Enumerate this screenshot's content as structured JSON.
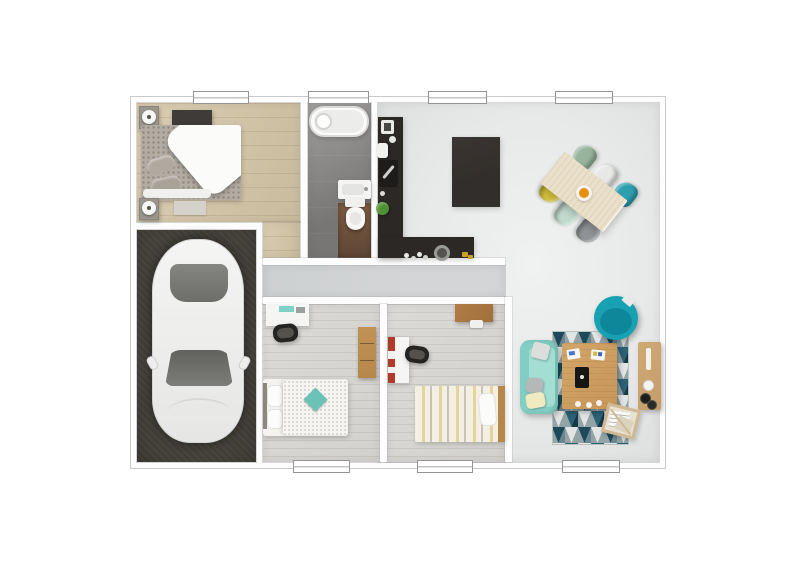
{
  "scene": {
    "type": "floor-plan-3d-render",
    "view": "top-down",
    "visible_text": [],
    "description": "Photorealistic top-down 3D floor plan of a single-storey house on a white background"
  },
  "palette": {
    "wallWhite": "#fdfdfd",
    "wallLine": "#c9cbcb",
    "openFloor": "#e7e9e9",
    "hallFloor": "#d3d5d6",
    "woodA": "#dbcdb2",
    "woodB": "#c9bb9e",
    "carpet": "#dcdad6",
    "tileA": "#a19f9d",
    "tileB": "#787674",
    "bathWoodA": "#7c5c44",
    "bathWoodB": "#5e4634",
    "garage": "#44413a",
    "counter": "#2b2826",
    "island": "#322e2b",
    "tableWood": "#eadfc8",
    "chairGreen": "#97b49c",
    "chairWhite": "#e8e9e7",
    "chairTeal": "#2d9fae",
    "chairYellow": "#d7c33b",
    "chairMint": "#c0d9cc",
    "chairGray": "#8f9395",
    "bowlOrange": "#e98f0e",
    "sofa": "#81cec3",
    "sofaSeat": "#a3ded3",
    "pillowGray": "#b4b8b8",
    "pillowYellow": "#f0eac0",
    "rugNavy": "#1d4a5a",
    "rugTeal": "#2b6275",
    "rugGray": "#93a3a6",
    "rugLight": "#e2e5e3",
    "coffeeWood": "#c79758",
    "armTeal": "#17a1b2",
    "armTealDark": "#0e7f92",
    "sideWood": "#c49c68",
    "bedWhite": "#f4f3f0",
    "cushTeal": "#6ac3b6",
    "stripeA": "#f4efe3",
    "stripeB": "#e2d39f",
    "stripeC": "#c9c3b5",
    "furnWood": "#b5874a",
    "shelfWood": "#a0703c",
    "black": "#242423",
    "deskWhite": "#f5f5f4",
    "red": "#b13a2d",
    "carBody": "#f2f2f1",
    "glassA": "#858581",
    "glassB": "#62625f",
    "bedGray": "#b2aca3",
    "lamp": "#f7f7f6",
    "plant": "#4f9035",
    "chrome": "#cfcfcd"
  },
  "rooms": [
    {
      "id": "bedroom-1",
      "floor": "wood",
      "furniture": [
        "double-bed",
        "wall-shelf-dark",
        "nightstand-with-lamp",
        "nightstand-with-lamp",
        "foot-mat"
      ]
    },
    {
      "id": "bathroom",
      "floor": "gray-tile-and-wood",
      "furniture": [
        "bathtub",
        "washbasin",
        "toilet"
      ]
    },
    {
      "id": "kitchen",
      "floor": "light-gray",
      "furniture": [
        "l-shaped-counter",
        "kitchen-island",
        "sink",
        "coffee-machine",
        "cooktop",
        "plant",
        "pot"
      ]
    },
    {
      "id": "dining-area",
      "floor": "light-gray",
      "furniture": [
        "dining-table",
        "6-chairs",
        "fruit-bowl"
      ]
    },
    {
      "id": "living-area",
      "floor": "light-gray",
      "furniture": [
        "sofa",
        "geometric-rug",
        "coffee-table",
        "swivel-armchair",
        "sideboard",
        "magazine-rack"
      ]
    },
    {
      "id": "hallway",
      "floor": "gray",
      "furniture": []
    },
    {
      "id": "garage",
      "floor": "dark-concrete",
      "furniture": [
        "car-white"
      ]
    },
    {
      "id": "bedroom-2",
      "floor": "carpet",
      "furniture": [
        "desk",
        "desk-chair",
        "wardrobe",
        "single-bed-teal-cushion"
      ]
    },
    {
      "id": "bedroom-3",
      "floor": "carpet",
      "furniture": [
        "desk-red-shelf",
        "desk-chair",
        "wall-shelf",
        "single-bed-striped"
      ]
    }
  ],
  "windows": {
    "top": [
      {
        "id": "bedroom-1-window",
        "x": 193,
        "w": 54
      },
      {
        "id": "bathroom-window",
        "x": 308,
        "w": 59
      },
      {
        "id": "kitchen-window",
        "x": 428,
        "w": 57
      },
      {
        "id": "dining-window",
        "x": 555,
        "w": 56
      }
    ],
    "bottom": [
      {
        "id": "bedroom-2-window",
        "x": 293,
        "w": 55
      },
      {
        "id": "bedroom-3-window",
        "x": 417,
        "w": 54
      },
      {
        "id": "living-window",
        "x": 562,
        "w": 56
      }
    ]
  },
  "dining": {
    "table": {
      "cx": 584,
      "cy": 192,
      "w": 80,
      "h": 40,
      "rotation_deg": 38
    },
    "chairs": [
      {
        "id": "green",
        "color": "chairGreen",
        "cx": 584,
        "cy": 157,
        "rot": -52
      },
      {
        "id": "white",
        "color": "chairWhite",
        "cx": 605,
        "cy": 176,
        "rot": -52
      },
      {
        "id": "teal",
        "color": "chairTeal",
        "cx": 625,
        "cy": 194,
        "rot": -52
      },
      {
        "id": "yellow",
        "color": "chairYellow",
        "cx": 552,
        "cy": 191,
        "rot": 128
      },
      {
        "id": "mint",
        "color": "chairMint",
        "cx": 567,
        "cy": 214,
        "rot": 128
      },
      {
        "id": "gray",
        "color": "chairGray",
        "cx": 589,
        "cy": 231,
        "rot": 128
      }
    ]
  }
}
